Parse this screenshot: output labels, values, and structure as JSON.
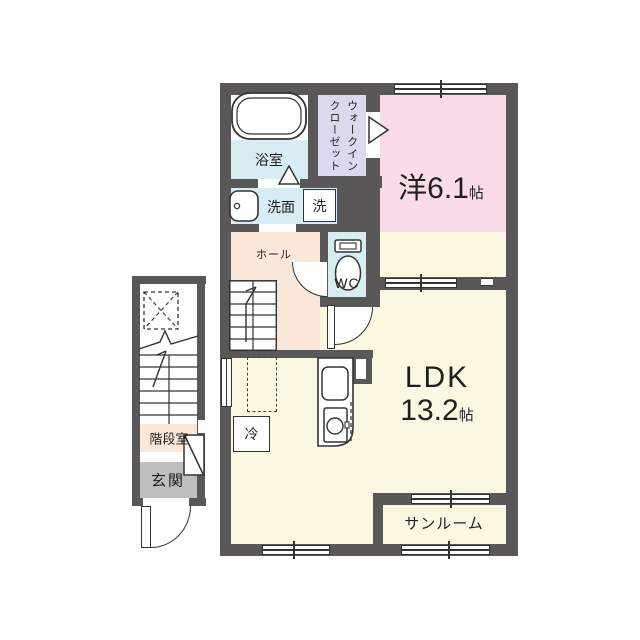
{
  "plan_type": "apartment-floor-plan",
  "rooms": {
    "bath": "浴室",
    "wic1": "ウォークイン",
    "wic2": "クローゼット",
    "washroom": "洗面",
    "laundry": "洗",
    "wc": "WC",
    "hall": "ホール",
    "western_name": "洋",
    "western_area": "6.1",
    "western_unit": "帖",
    "ldk_name": "LDK",
    "ldk_area": "13.2",
    "ldk_unit": "帖",
    "sunroom": "サンルーム",
    "fridge": "冷",
    "stairwell": "階段室",
    "entrance": "玄関"
  },
  "colors": {
    "wall": "#595757",
    "water_rooms": "#d7edf3",
    "closet": "#dbd9ee",
    "bedroom": "#fadce8",
    "hall": "#f9e7da",
    "living": "#fbf7e0",
    "entrance": "#bebebe",
    "line": "#333333"
  }
}
